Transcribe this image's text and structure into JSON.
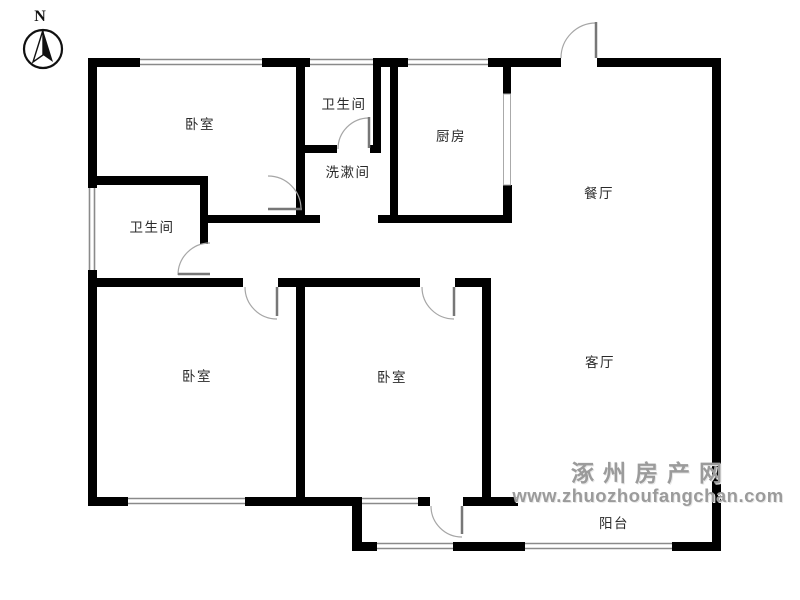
{
  "compass": {
    "label": "N"
  },
  "rooms": [
    {
      "id": "bedroom-top-left",
      "label": "卧室"
    },
    {
      "id": "bathroom-top",
      "label": "卫生间"
    },
    {
      "id": "washroom",
      "label": "洗漱间"
    },
    {
      "id": "kitchen",
      "label": "厨房"
    },
    {
      "id": "dining-room",
      "label": "餐厅"
    },
    {
      "id": "bathroom-left",
      "label": "卫生间"
    },
    {
      "id": "bedroom-bottom-left",
      "label": "卧室"
    },
    {
      "id": "bedroom-middle",
      "label": "卧室"
    },
    {
      "id": "living-room",
      "label": "客厅"
    },
    {
      "id": "balcony",
      "label": "阳台"
    }
  ],
  "watermark": {
    "site_name": "涿州房产网",
    "site_url": "www.zhuozhoufangchan.com"
  },
  "colors": {
    "wall": "#000000",
    "window_line": "#8a8a8a",
    "door_arc": "#a6a6a6",
    "door_leaf": "#777777",
    "label_text": "#2a2a2a",
    "watermark_text": "#9b9b9b",
    "background": "#ffffff"
  }
}
